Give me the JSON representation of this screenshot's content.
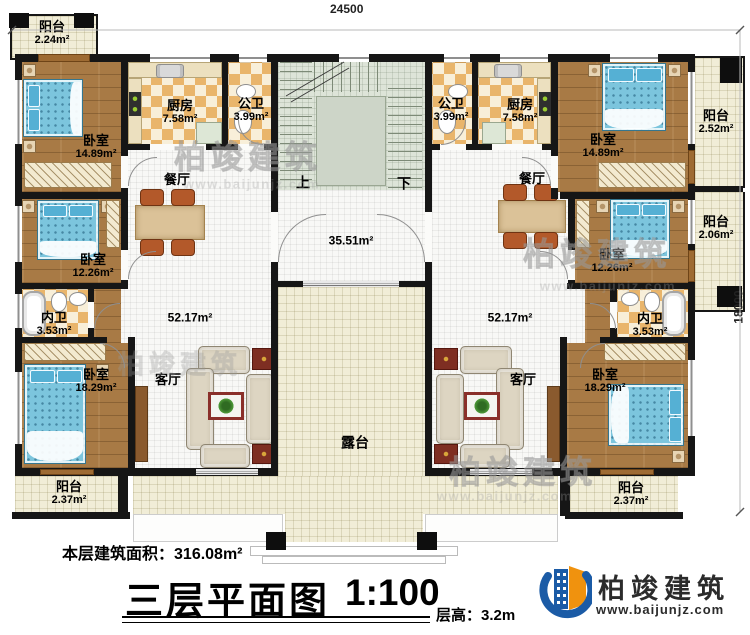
{
  "dimensions": {
    "top": "24500",
    "right": "18000"
  },
  "stairs": {
    "up": "上",
    "down": "下"
  },
  "rooms": {
    "balcony_tl": {
      "name": "阳台",
      "area": "2.24m²"
    },
    "bedroom_l1": {
      "name": "卧室",
      "area": "14.89m²"
    },
    "kitchen_l": {
      "name": "厨房",
      "area": "7.58m²"
    },
    "bath_l": {
      "name": "公卫",
      "area": "3.99m²"
    },
    "dining_l": {
      "name": "餐厅"
    },
    "bedroom_l2": {
      "name": "卧室",
      "area": "12.26m²"
    },
    "ensuite_l": {
      "name": "内卫",
      "area": "3.53m²"
    },
    "bedroom_l3": {
      "name": "卧室",
      "area": "18.29m²"
    },
    "living_l": {
      "name": "客厅",
      "area": "52.17m²"
    },
    "balcony_bl": {
      "name": "阳台",
      "area": "2.37m²"
    },
    "hall": {
      "area": "35.51m²"
    },
    "terrace": {
      "name": "露台"
    },
    "bath_r": {
      "name": "公卫",
      "area": "3.99m²"
    },
    "kitchen_r": {
      "name": "厨房",
      "area": "7.58m²"
    },
    "bedroom_r1": {
      "name": "卧室",
      "area": "14.89m²"
    },
    "balcony_r1": {
      "name": "阳台",
      "area": "2.52m²"
    },
    "dining_r": {
      "name": "餐厅"
    },
    "bedroom_r2": {
      "name": "卧室",
      "area": "12.26m²"
    },
    "balcony_r2": {
      "name": "阳台",
      "area": "2.06m²"
    },
    "ensuite_r": {
      "name": "内卫",
      "area": "3.53m²"
    },
    "bedroom_r3": {
      "name": "卧室",
      "area": "18.29m²"
    },
    "living_r": {
      "name": "客厅",
      "area": "52.17m²"
    },
    "balcony_br": {
      "name": "阳台",
      "area": "2.37m²"
    }
  },
  "footer": {
    "area_label": "本层建筑面积：",
    "area_value": "316.08m²",
    "title": "三层平面图",
    "scale": "1:100",
    "floor_height_label": "层高：",
    "floor_height_value": "3.2m"
  },
  "logo": {
    "brand": "柏竣建筑",
    "url": "www.baijunjz.com"
  },
  "watermark": {
    "brand": "柏竣建筑",
    "url": "www.baijunjz.com"
  },
  "colors": {
    "logo_blue": "#1b5ba6",
    "logo_orange": "#f0920e",
    "wall": "#161616",
    "bed_blue": "#7cc5dd",
    "wood": "#a87a45"
  }
}
